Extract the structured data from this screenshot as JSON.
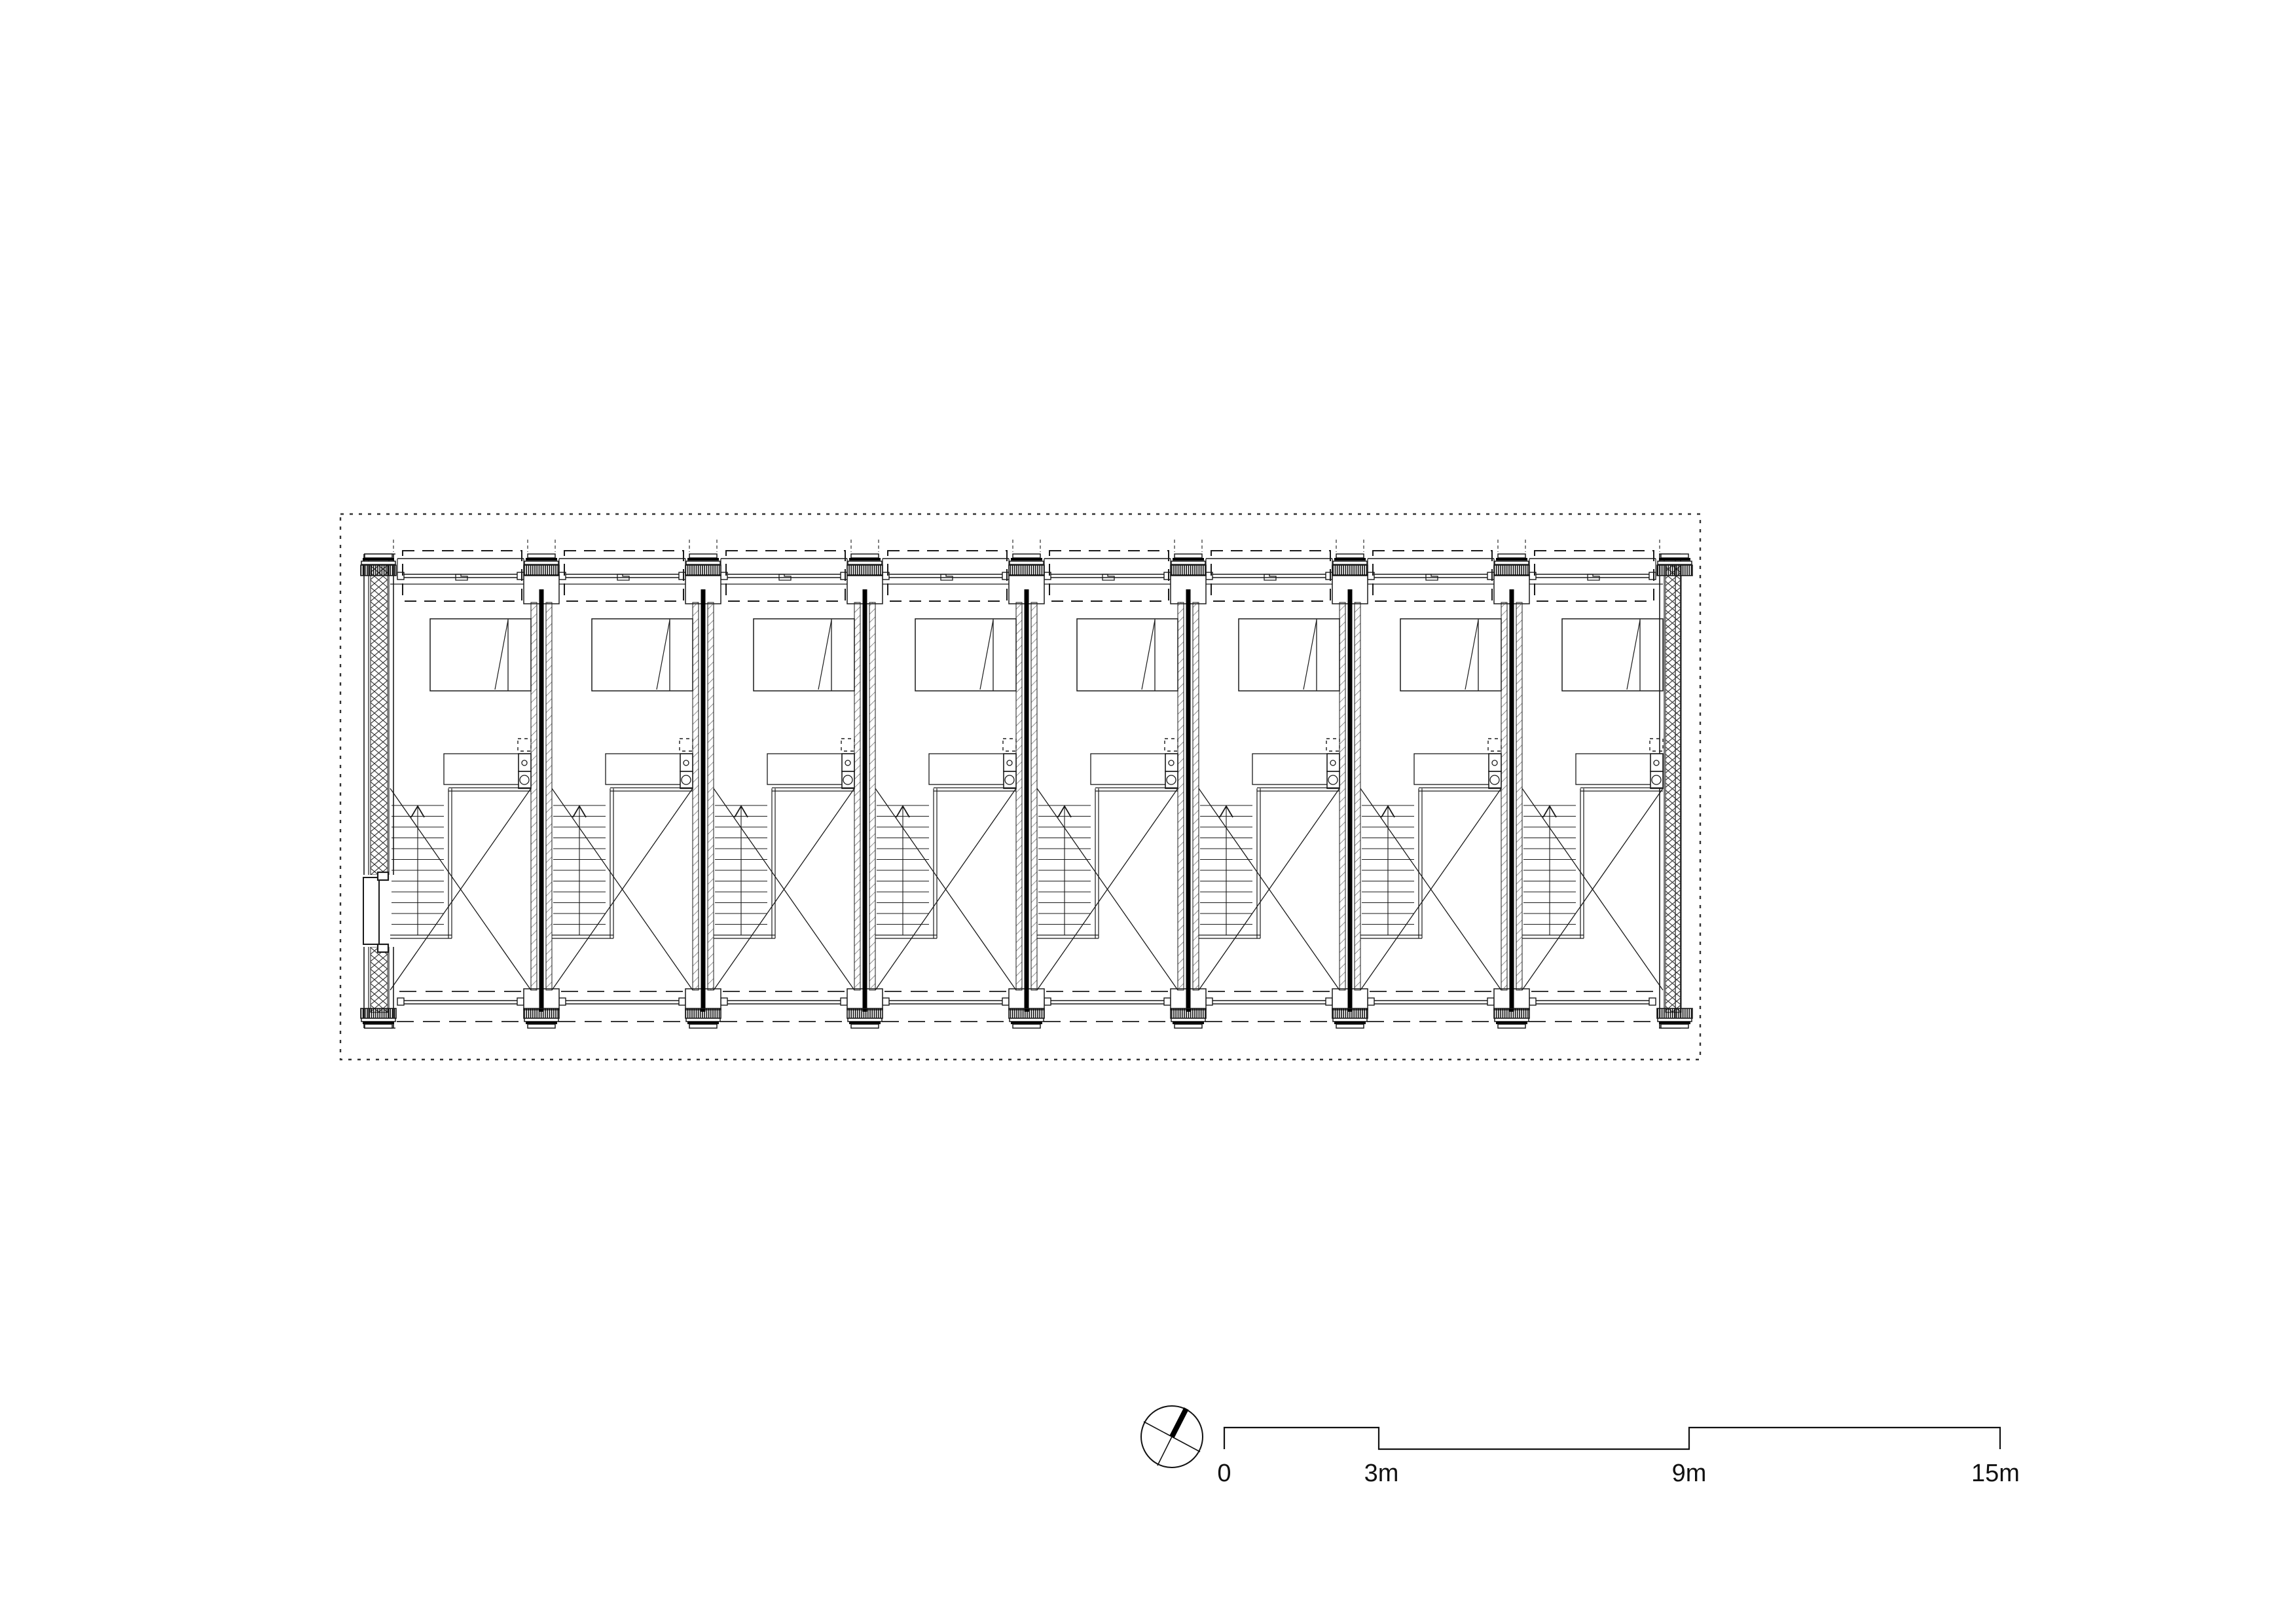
{
  "drawing": {
    "type": "terraced-housing-floor-plan",
    "unit_count": 8
  },
  "scale_bar": {
    "labels": [
      "0",
      "3m",
      "9m",
      "15m"
    ]
  },
  "compass": {
    "type": "north-arrow"
  },
  "colors": {
    "line": "#1a1a1a",
    "hatch": "#444444",
    "paper": "#ffffff"
  }
}
